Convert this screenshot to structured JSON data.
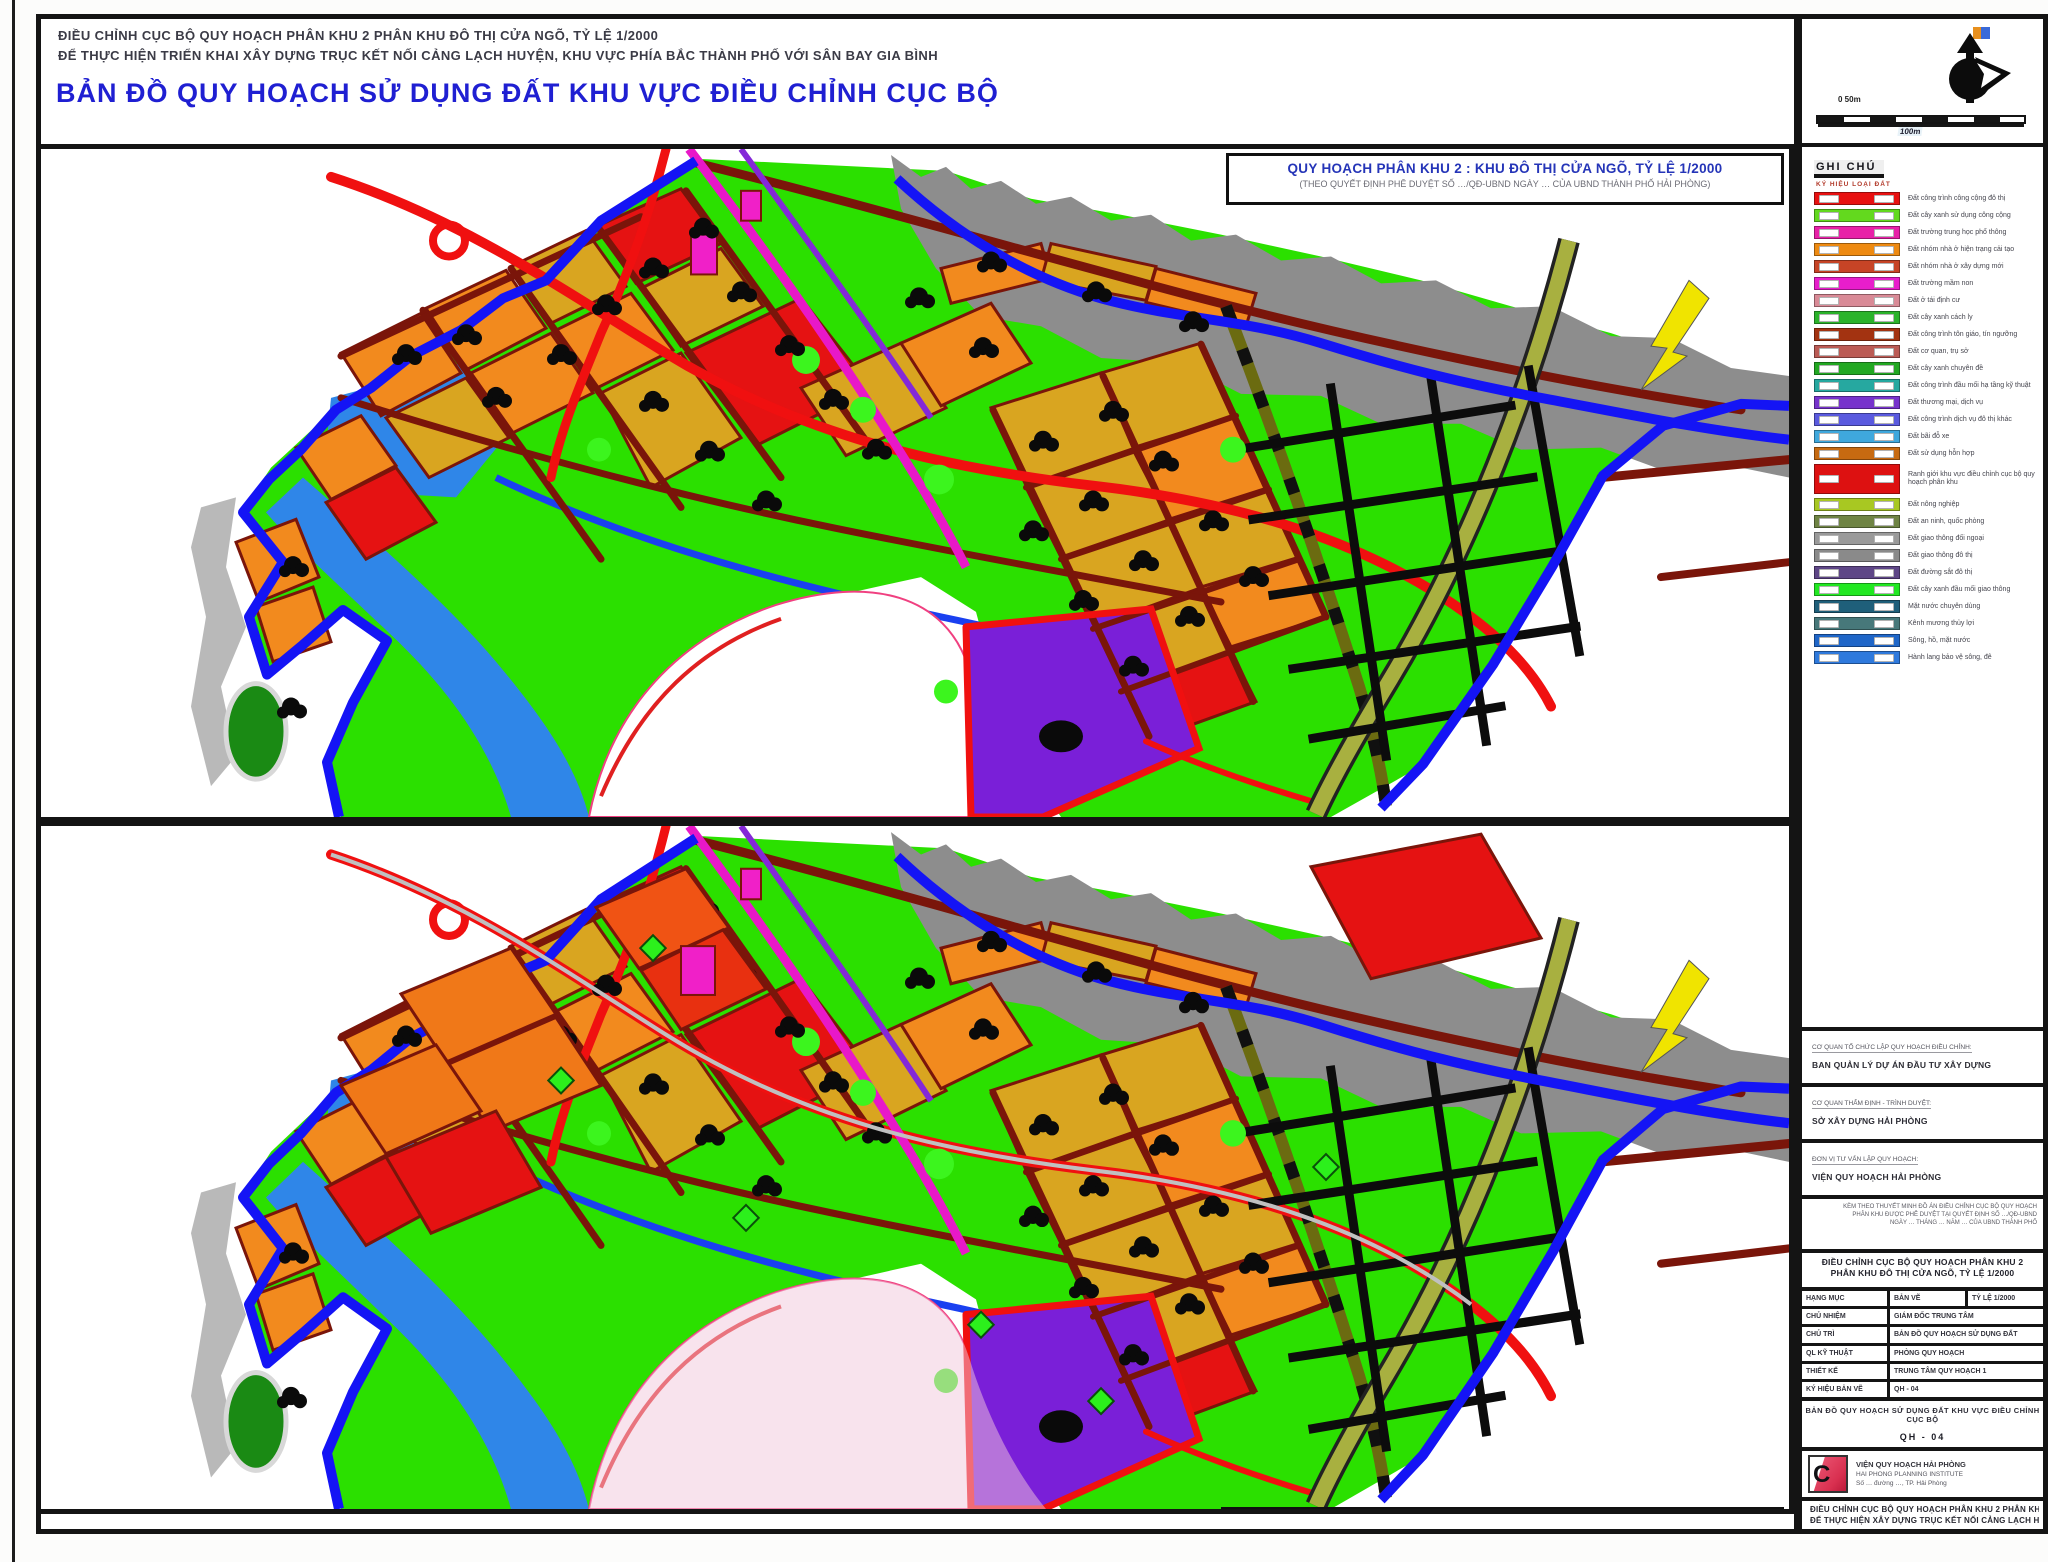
{
  "header": {
    "line1": "ĐIỀU CHỈNH CỤC BỘ QUY HOẠCH PHÂN KHU 2 PHÂN KHU ĐÔ THỊ CỬA NGÕ, TỶ LỆ 1/2000",
    "line2": "ĐỂ THỰC HIỆN TRIỂN KHAI XÂY DỰNG TRỤC KẾT NỐI CẢNG LẠCH HUYỆN, KHU VỰC PHÍA BẮC THÀNH PHỐ VỚI SÂN BAY GIA BÌNH",
    "title": "BẢN ĐỒ QUY HOẠCH SỬ DỤNG ĐẤT  KHU VỰC ĐIỀU CHỈNH CỤC BỘ",
    "title_color": "#1f1fd2"
  },
  "maps": {
    "top_banner_line1": "QUY HOẠCH PHÂN KHU 2 : KHU ĐÔ THỊ CỬA NGÕ, TỶ LỆ 1/2000",
    "top_banner_line2": "(THEO QUYẾT ĐỊNH PHÊ DUYỆT SỐ …/QĐ-UBND NGÀY … CỦA UBND THÀNH PHỐ HẢI PHÒNG)",
    "bottom_banner": "ĐIỀU CHỈNH KỲ NÀY"
  },
  "map_palette": {
    "green_land": "#2be000",
    "ochre_parcel": "#d9a520",
    "orange_parcel": "#f28a1e",
    "red_parcel": "#e51212",
    "red_road": "#f01010",
    "dark_red_road": "#7a150a",
    "boundary_blue": "#1414f5",
    "water_blue": "#2f86e8",
    "magenta_road": "#e818c8",
    "purple_road": "#8428d8",
    "purple_parcel": "#7a1fd8",
    "olive_road": "#6b6b10",
    "khaki_road": "#a8b040",
    "coast_gray": "#8d8d8d",
    "arrow_yellow": "#f0e400"
  },
  "sidebar": {
    "north": {
      "flag_label": "B",
      "scale_top": "0  50m",
      "scale_bottom": "100m"
    },
    "legend": {
      "title": "GHI CHÚ",
      "subtitle": "KÝ HIỆU              LOẠI ĐẤT",
      "items": [
        {
          "color": "#e81111",
          "label": "Đất công trình công cộng đô thị"
        },
        {
          "color": "#63d91e",
          "label": "Đất cây xanh sử dụng công cộng"
        },
        {
          "color": "#e821a8",
          "label": "Đất trường trung học phổ thông"
        },
        {
          "color": "#ee8a11",
          "label": "Đất nhóm nhà ở hiện trạng cải tạo"
        },
        {
          "color": "#c74426",
          "label": "Đất nhóm nhà ở xây dựng mới"
        },
        {
          "color": "#e81ecb",
          "label": "Đất trường mầm non"
        },
        {
          "color": "#d98a96",
          "label": "Đất ở tái định cư"
        },
        {
          "color": "#2bb32b",
          "label": "Đất cây xanh cách ly"
        },
        {
          "color": "#a33311",
          "label": "Đất công trình tôn giáo, tín ngưỡng"
        },
        {
          "color": "#bb5b55",
          "label": "Đất cơ quan, trụ sở"
        },
        {
          "color": "#22a822",
          "label": "Đất cây xanh chuyên đề"
        },
        {
          "color": "#26a8a0",
          "label": "Đất công trình đầu mối hạ tầng kỹ thuật"
        },
        {
          "color": "#7733cc",
          "label": "Đất thương mại, dịch vụ"
        },
        {
          "color": "#5a5adf",
          "label": "Đất công trình dịch vụ đô thị khác"
        },
        {
          "color": "#3fa8dd",
          "label": "Đất bãi đỗ xe"
        },
        {
          "color": "#c76a11",
          "label": "Đất sử dụng hỗn hợp"
        },
        {
          "color": "#dd1111",
          "label": "Ranh giới khu vực điều chỉnh cục bộ quy hoạch phân khu",
          "tall": true
        },
        {
          "color": "#a8c822",
          "label": "Đất nông nghiệp"
        },
        {
          "color": "#6f8444",
          "label": "Đất an ninh, quốc phòng"
        },
        {
          "color": "#9a9a9a",
          "label": "Đất giao thông đối ngoại"
        },
        {
          "color": "#8a8a8a",
          "label": "Đất giao thông đô thị"
        },
        {
          "color": "#5e4687",
          "label": "Đất đường sắt đô thị"
        },
        {
          "color": "#22e822",
          "label": "Đất cây xanh đầu mối giao thông"
        },
        {
          "color": "#1f5f7a",
          "label": "Mặt nước chuyên dùng"
        },
        {
          "color": "#47787a",
          "label": "Kênh mương thủy lợi"
        },
        {
          "color": "#1f66c8",
          "label": "Sông, hồ, mặt nước"
        },
        {
          "color": "#2f7add",
          "label": "Hành lang bảo vệ sông, đê"
        }
      ]
    },
    "title_block": {
      "agencies": [
        {
          "small": "CƠ QUAN TỔ CHỨC LẬP QUY HOẠCH ĐIỀU CHỈNH:",
          "main": "BAN QUẢN LÝ DỰ ÁN ĐẦU TƯ XÂY DỰNG"
        },
        {
          "small": "CƠ QUAN THẨM ĐỊNH - TRÌNH DUYỆT:",
          "main": "SỞ XÂY DỰNG HẢI PHÒNG"
        },
        {
          "small": "ĐƠN VỊ TƯ VẤN LẬP QUY HOẠCH:",
          "main": "VIỆN QUY HOẠCH HẢI PHÒNG"
        }
      ],
      "note_lines": [
        "KÈM THEO THUYẾT MINH ĐỒ ÁN ĐIỀU CHỈNH CỤC BỘ QUY HOẠCH",
        "PHÂN KHU ĐƯỢC PHÊ DUYỆT TẠI QUYẾT ĐỊNH SỐ …/QĐ-UBND",
        "NGÀY … THÁNG … NĂM … CỦA UBND THÀNH PHỐ"
      ],
      "drawing_title_1": "ĐIỀU CHỈNH CỤC BỘ QUY HOẠCH PHÂN KHU 2",
      "drawing_title_2": "PHÂN KHU ĐÔ THỊ CỬA NGÕ, TỶ LỆ 1/2000",
      "table": [
        {
          "cells": [
            "HẠNG MỤC",
            "BẢN VẼ",
            "TỶ LỆ 1/2000"
          ]
        },
        {
          "cells": [
            "CHỦ NHIỆM",
            "GIÁM ĐỐC TRUNG TÂM"
          ]
        },
        {
          "cells": [
            "CHỦ TRÌ",
            "BẢN ĐỒ QUY HOẠCH SỬ DỤNG ĐẤT"
          ]
        },
        {
          "cells": [
            "QL KỸ THUẬT",
            "PHÒNG QUY HOẠCH"
          ]
        },
        {
          "cells": [
            "THIẾT KẾ",
            "TRUNG TÂM QUY HOẠCH 1"
          ]
        },
        {
          "cells": [
            "KÝ HIỆU BẢN VẼ",
            "QH - 04"
          ]
        }
      ],
      "sheet_title": "BẢN ĐỒ QUY HOẠCH SỬ DỤNG ĐẤT KHU VỰC ĐIỀU CHỈNH CỤC BỘ",
      "sheet_number": "QH - 04"
    },
    "logo": {
      "letter": "C",
      "lines": [
        "VIỆN QUY HOẠCH HẢI PHÒNG",
        "HAI PHONG PLANNING INSTITUTE",
        "Số … đường …, TP. Hải Phòng"
      ]
    },
    "footer_lines": [
      "ĐIỀU CHỈNH CỤC BỘ QUY HOẠCH PHÂN KHU 2 PHÂN KHU ĐÔ THỊ CỬA NGÕ",
      "ĐỂ THỰC HIỆN XÂY DỰNG TRỤC KẾT NỐI CẢNG LẠCH HUYỆN"
    ]
  }
}
